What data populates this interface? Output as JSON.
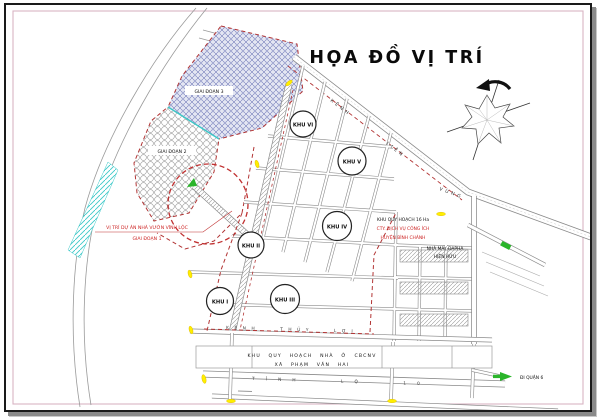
{
  "title": "HỌA ĐỒ VỊ TRÍ",
  "colors": {
    "boundary_red": "#b23434",
    "label_red": "#cc2222",
    "hatch_blue": "#8088c0",
    "canal_cyan": "#3cc8c8",
    "marker_yellow": "#ffee00",
    "marker_green": "#2ab52a",
    "road_gray": "#8a8a8a",
    "inner_border_pink": "#d8b4c4"
  },
  "parcel": {
    "phase3_label": "GIAI ĐOẠN 3",
    "phase2_label": "GIAI ĐOẠN 2",
    "location_label_line1": "VỊ TRÍ DỰ ÁN NHÀ VƯỜN VĨNH LỘC",
    "location_label_line2": "GIAI ĐOẠN 1"
  },
  "zones": [
    {
      "label": "KHU I"
    },
    {
      "label": "KHU II"
    },
    {
      "label": "KHU III"
    },
    {
      "label": "KHU IV"
    },
    {
      "label": "KHU V"
    },
    {
      "label": "KHU VI"
    }
  ],
  "roads": {
    "canal_parts": [
      "KÊNH",
      "LIÊN",
      "VÙNG"
    ],
    "irrigation_canal": "KÊNH THỦY LỢI",
    "provincial_road": "TỈNH LỘ 10"
  },
  "annotations": {
    "planning_line1": "KHU QUY HOẠCH 16 Ha",
    "planning_line2": "CTY. DỊCH VỤ CÔNG ÍCH",
    "planning_line3": "HUYỆN BÌNH CHÁNH",
    "factory_line1": "NHÀ MÁY DAPHA",
    "factory_line2": "HIỆN HỮU",
    "housing_line1": "KHU QUY HOẠCH NHÀ Ở CBCNV",
    "housing_line2": "XÃ PHẠM VĂN HAI",
    "exit_east": "ĐI QUẬN 6"
  }
}
